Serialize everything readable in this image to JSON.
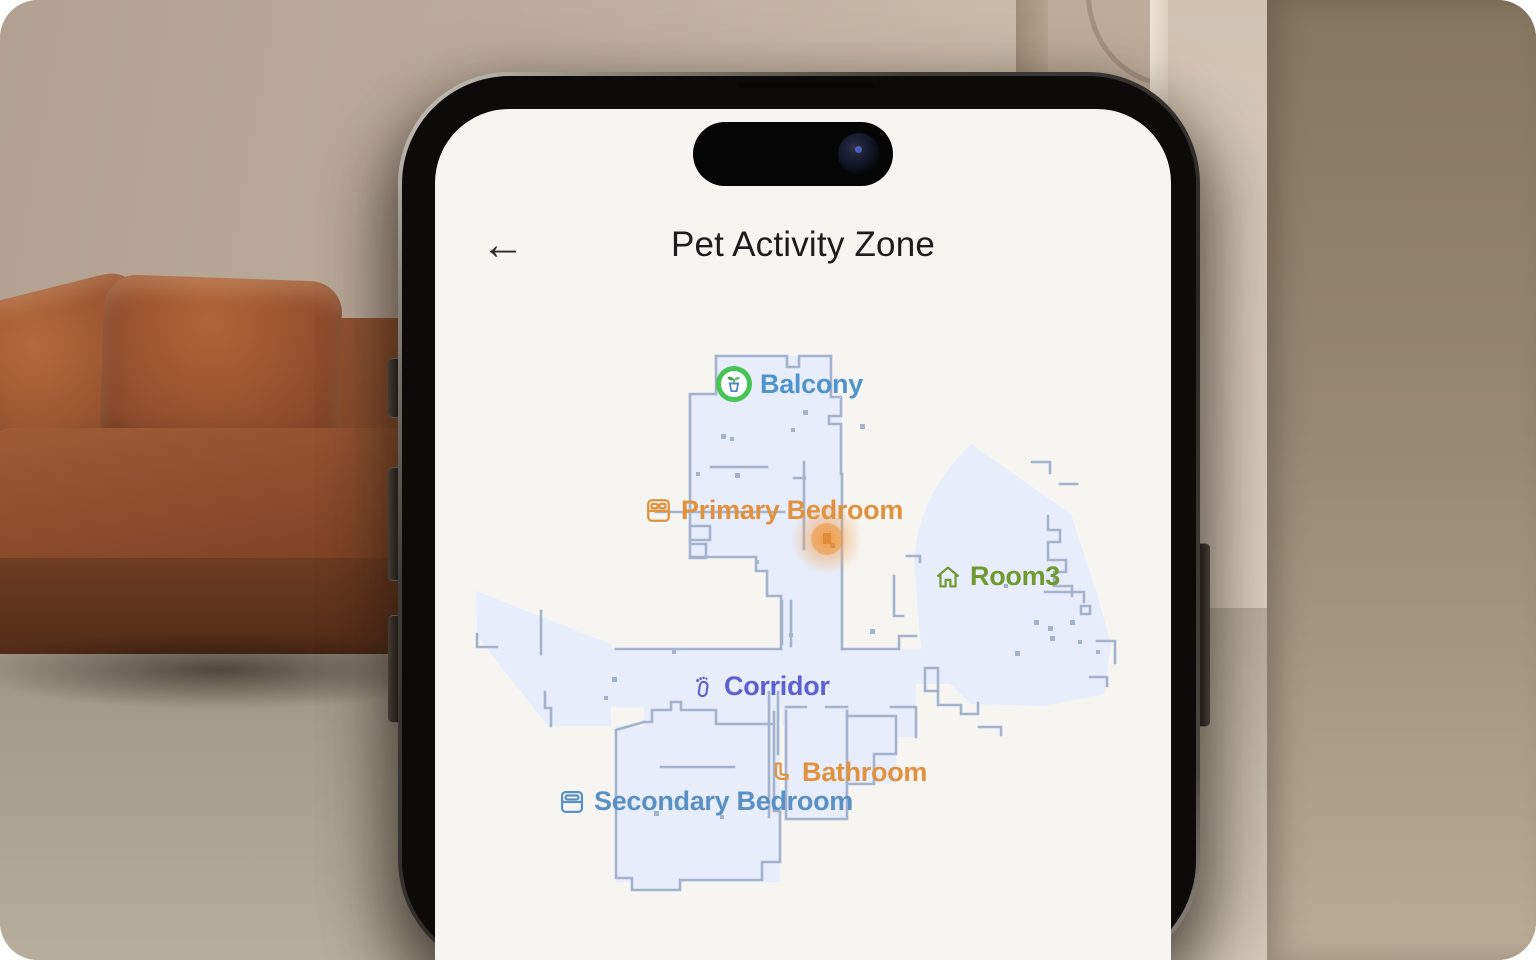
{
  "header": {
    "back_icon": "←",
    "title": "Pet Activity Zone"
  },
  "map": {
    "rooms": [
      {
        "label": "Balcony",
        "icon": "plant-pot-icon",
        "color": "#4f94cd"
      },
      {
        "label": "Primary Bedroom",
        "icon": "bed-icon",
        "color": "#e0923e"
      },
      {
        "label": "Room3",
        "icon": "house-icon",
        "color": "#6e9a2f"
      },
      {
        "label": "Corridor",
        "icon": "footprint-icon",
        "color": "#5d60d0"
      },
      {
        "label": "Bathroom",
        "icon": "toilet-icon",
        "color": "#e0923e"
      },
      {
        "label": "Secondary Bedroom",
        "icon": "bed-icon",
        "color": "#5a90c3"
      }
    ],
    "heat_spot_color": "#f0953a",
    "floor_fill": "#e7edfa",
    "wall_color": "#a4b3cd"
  }
}
